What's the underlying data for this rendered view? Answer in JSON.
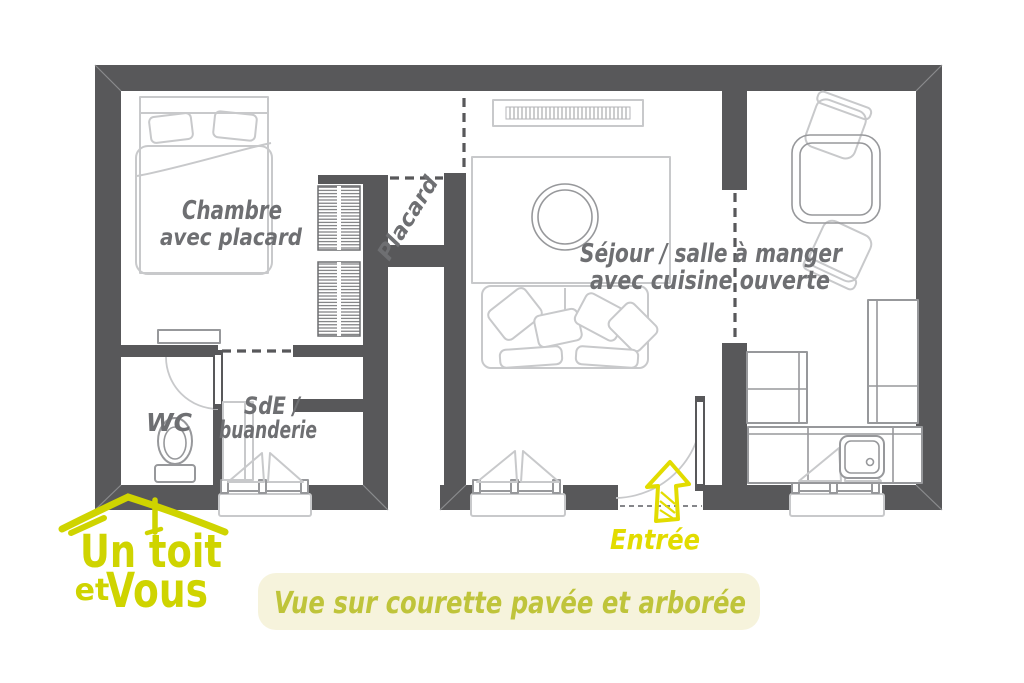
{
  "colors": {
    "wall": "#58585a",
    "furniture": "#c8c9cb",
    "midgray": "#97989b",
    "label": "#6e6f72",
    "logo_yellow": "#cfd400",
    "entree_yellow": "#e2dc00",
    "banner_bg": "#f6f3dc",
    "banner_text": "#bfc43a"
  },
  "labels": {
    "bedroom": {
      "line1": "Chambre",
      "line2": "avec placard"
    },
    "closet": {
      "label": "Placard"
    },
    "living": {
      "line1": "Séjour / salle à manger",
      "line2": "avec cuisine ouverte"
    },
    "wc": {
      "label": "WC"
    },
    "bathroom": {
      "line1": "SdE /",
      "line2": "buanderie"
    },
    "entrance": {
      "label": "Entrée"
    }
  },
  "banner": {
    "text": "Vue sur courette pavée et arborée"
  },
  "logo": {
    "line1": "Un toit",
    "line2_small": "et",
    "line2_large": "Vous"
  }
}
